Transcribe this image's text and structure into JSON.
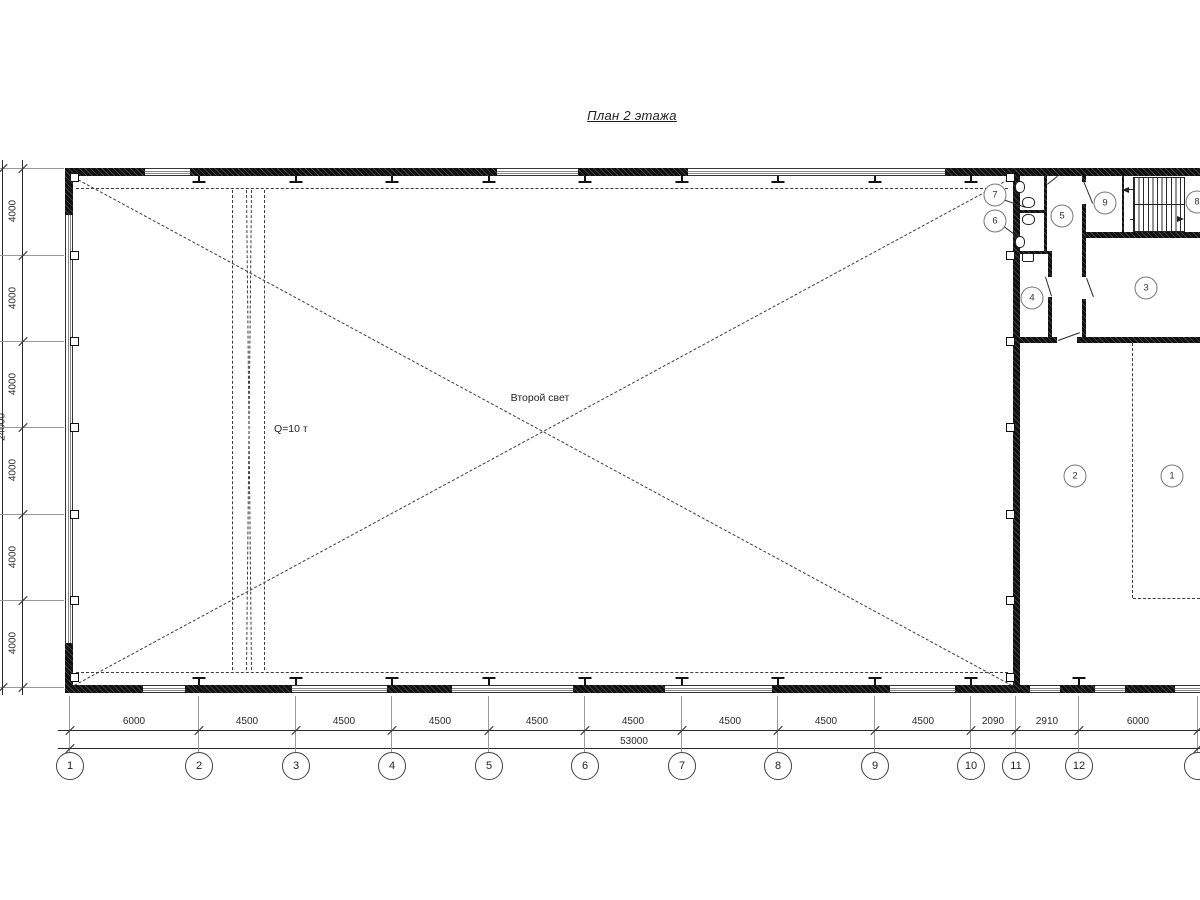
{
  "title": "План 2 этажа",
  "labels": {
    "second_light": "Второй свет",
    "crane_capacity": "Q=10 т",
    "total_bottom": "53000",
    "total_left": "24000"
  },
  "colors": {
    "ink": "#1a1a1a",
    "dash": "#3c3c3c",
    "extension": "#9a9a9a",
    "paper": "#ffffff"
  },
  "axes_bottom": [
    {
      "label": "1",
      "x": 70
    },
    {
      "label": "2",
      "x": 199
    },
    {
      "label": "3",
      "x": 296
    },
    {
      "label": "4",
      "x": 392
    },
    {
      "label": "5",
      "x": 489
    },
    {
      "label": "6",
      "x": 585
    },
    {
      "label": "7",
      "x": 682
    },
    {
      "label": "8",
      "x": 778
    },
    {
      "label": "9",
      "x": 875
    },
    {
      "label": "10",
      "x": 971
    },
    {
      "label": "11",
      "x": 1016
    },
    {
      "label": "12",
      "x": 1079
    },
    {
      "label": "",
      "x": 1198
    }
  ],
  "dims_bottom": [
    {
      "text": "6000",
      "x": 134
    },
    {
      "text": "4500",
      "x": 247
    },
    {
      "text": "4500",
      "x": 344
    },
    {
      "text": "4500",
      "x": 440
    },
    {
      "text": "4500",
      "x": 537
    },
    {
      "text": "4500",
      "x": 633
    },
    {
      "text": "4500",
      "x": 730
    },
    {
      "text": "4500",
      "x": 826
    },
    {
      "text": "4500",
      "x": 923
    },
    {
      "text": "2090",
      "x": 993
    },
    {
      "text": "2910",
      "x": 1047
    },
    {
      "text": "6000",
      "x": 1138
    }
  ],
  "dims_left": [
    {
      "text": "4000",
      "y": 211
    },
    {
      "text": "4000",
      "y": 298
    },
    {
      "text": "4000",
      "y": 384
    },
    {
      "text": "4000",
      "y": 470
    },
    {
      "text": "4000",
      "y": 557
    },
    {
      "text": "4000",
      "y": 643
    }
  ],
  "rooms": [
    {
      "n": "1",
      "x": 1172,
      "y": 476
    },
    {
      "n": "2",
      "x": 1075,
      "y": 476
    },
    {
      "n": "3",
      "x": 1146,
      "y": 288
    },
    {
      "n": "4",
      "x": 1032,
      "y": 298
    },
    {
      "n": "5",
      "x": 1062,
      "y": 216
    },
    {
      "n": "6",
      "x": 995,
      "y": 221
    },
    {
      "n": "7",
      "x": 995,
      "y": 195
    },
    {
      "n": "8",
      "x": 1197,
      "y": 202
    },
    {
      "n": "9",
      "x": 1105,
      "y": 203
    }
  ],
  "drawing": {
    "walls": [
      {
        "name": "top-wall",
        "x": 65,
        "y": 168,
        "w": 1135,
        "h": 8
      },
      {
        "name": "bottom-wall",
        "x": 65,
        "y": 685,
        "w": 1135,
        "h": 8
      },
      {
        "name": "left-wall-top",
        "x": 65,
        "y": 168,
        "w": 8,
        "h": 47
      },
      {
        "name": "left-wall-bottom",
        "x": 65,
        "y": 643,
        "w": 8,
        "h": 50
      },
      {
        "name": "divider-wall",
        "x": 1013,
        "y": 168,
        "w": 7,
        "h": 525
      },
      {
        "name": "toilet-partition",
        "x": 1044,
        "y": 176,
        "w": 3,
        "h": 78
      },
      {
        "name": "stall-partition",
        "x": 1020,
        "y": 210,
        "w": 24,
        "h": 3
      },
      {
        "name": "room4-top-wall",
        "x": 1020,
        "y": 251,
        "w": 32,
        "h": 3
      },
      {
        "name": "room4-right-wall",
        "x": 1048,
        "y": 251,
        "w": 4,
        "h": 26
      },
      {
        "name": "room4-right-wall",
        "x": 1048,
        "y": 297,
        "w": 4,
        "h": 45
      },
      {
        "name": "corridor-wall",
        "x": 1082,
        "y": 176,
        "w": 4,
        "h": 6
      },
      {
        "name": "corridor-wall",
        "x": 1082,
        "y": 204,
        "w": 4,
        "h": 73
      },
      {
        "name": "corridor-wall",
        "x": 1082,
        "y": 299,
        "w": 4,
        "h": 43
      },
      {
        "name": "understair-wall",
        "x": 1086,
        "y": 232,
        "w": 114,
        "h": 6
      },
      {
        "name": "stair-left-wall",
        "x": 1122,
        "y": 176,
        "w": 2,
        "h": 56
      },
      {
        "name": "room3-bottom-wall",
        "x": 1020,
        "y": 337,
        "w": 37,
        "h": 6
      },
      {
        "name": "room3-bottom-wall",
        "x": 1077,
        "y": 337,
        "w": 123,
        "h": 6
      }
    ],
    "windows_h": [
      {
        "x": 145,
        "y": 168,
        "w": 45
      },
      {
        "x": 497,
        "y": 168,
        "w": 81
      },
      {
        "x": 688,
        "y": 168,
        "w": 257
      },
      {
        "x": 143,
        "y": 685,
        "w": 42
      },
      {
        "x": 292,
        "y": 685,
        "w": 95
      },
      {
        "x": 452,
        "y": 685,
        "w": 121
      },
      {
        "x": 665,
        "y": 685,
        "w": 107
      },
      {
        "x": 890,
        "y": 685,
        "w": 65
      },
      {
        "x": 1030,
        "y": 685,
        "w": 30
      },
      {
        "x": 1095,
        "y": 685,
        "w": 30
      },
      {
        "x": 1175,
        "y": 685,
        "w": 25
      }
    ],
    "windows_v": [
      {
        "x": 65,
        "y": 215,
        "h": 428
      }
    ],
    "lines": [
      {
        "name": "diagonal-cross",
        "x1": 74,
        "y1": 177,
        "x2": 1012,
        "y2": 685,
        "dash": true
      },
      {
        "name": "diagonal-cross",
        "x1": 74,
        "y1": 685,
        "x2": 1012,
        "y2": 177,
        "dash": true
      },
      {
        "name": "opening-outline-top",
        "x1": 76,
        "y1": 188,
        "x2": 1008,
        "y2": 188,
        "dash": true
      },
      {
        "name": "opening-outline-bottom",
        "x1": 76,
        "y1": 672,
        "x2": 1008,
        "y2": 672,
        "dash": true
      },
      {
        "name": "crane-rail",
        "x1": 233,
        "y1": 190,
        "x2": 233,
        "y2": 670,
        "dash": true
      },
      {
        "name": "crane-rail",
        "x1": 265,
        "y1": 190,
        "x2": 265,
        "y2": 670,
        "dash": true
      },
      {
        "name": "crane-brace",
        "x1": 247,
        "y1": 190,
        "x2": 252,
        "y2": 670,
        "dash": true
      },
      {
        "name": "crane-brace",
        "x1": 252,
        "y1": 190,
        "x2": 247,
        "y2": 670,
        "dash": true
      },
      {
        "name": "room-divider-dashed",
        "x1": 1133,
        "y1": 343,
        "x2": 1133,
        "y2": 598,
        "dash": true
      },
      {
        "name": "room-divider-dashed",
        "x1": 1133,
        "y1": 598,
        "x2": 1200,
        "y2": 598,
        "dash": true
      },
      {
        "name": "leader-room7",
        "x1": 1003,
        "y1": 199,
        "x2": 1026,
        "y2": 207
      },
      {
        "name": "leader-room6",
        "x1": 1004,
        "y1": 226,
        "x2": 1024,
        "y2": 241
      },
      {
        "name": "door-leaf",
        "x1": 1084,
        "y1": 181,
        "x2": 1093,
        "y2": 203
      },
      {
        "name": "door-leaf",
        "x1": 1087,
        "y1": 278,
        "x2": 1094,
        "y2": 297
      },
      {
        "name": "door-leaf",
        "x1": 1046,
        "y1": 277,
        "x2": 1052,
        "y2": 296
      },
      {
        "name": "door-leaf",
        "x1": 1058,
        "y1": 340,
        "x2": 1080,
        "y2": 332
      },
      {
        "name": "door-leaf",
        "x1": 1047,
        "y1": 184,
        "x2": 1057,
        "y2": 176
      },
      {
        "name": "stair-arrow-line",
        "x1": 1180,
        "y1": 190,
        "x2": 1128,
        "y2": 190
      },
      {
        "name": "stair-arrow-line",
        "x1": 1130,
        "y1": 219,
        "x2": 1178,
        "y2": 219
      },
      {
        "name": "dim-rail",
        "x1": 58,
        "y1": 730,
        "x2": 1200,
        "y2": 730
      },
      {
        "name": "dim-rail",
        "x1": 58,
        "y1": 748,
        "x2": 1200,
        "y2": 748
      },
      {
        "name": "dim-rail-left",
        "x1": 23,
        "y1": 160,
        "x2": 23,
        "y2": 695
      },
      {
        "name": "dim-rail-left-outer",
        "x1": 3,
        "y1": 160,
        "x2": 3,
        "y2": 695
      }
    ],
    "ext_v_x": [
      70,
      199,
      296,
      392,
      489,
      585,
      682,
      778,
      875,
      971,
      1016,
      1079,
      1198
    ],
    "ext_h_y": [
      168,
      255,
      341,
      427,
      514,
      600,
      687
    ],
    "ticks_row1_y": 730,
    "ticks_row2": [
      {
        "x": 70,
        "y": 748
      },
      {
        "x": 1198,
        "y": 748
      }
    ],
    "ticks_left_x": 23,
    "ticks_left_outer": [
      {
        "x": 3,
        "y": 168
      },
      {
        "x": 3,
        "y": 687
      }
    ],
    "cols_top_x": [
      199,
      296,
      392,
      489,
      585,
      682,
      778,
      875,
      971
    ],
    "cols_bottom_x": [
      199,
      296,
      392,
      489,
      585,
      682,
      778,
      875,
      971,
      1079
    ],
    "squares_y": [
      177,
      255,
      341,
      427,
      514,
      600,
      677
    ],
    "fixtures": [
      {
        "name": "wc-fixture",
        "x": 1015,
        "y": 181,
        "w": 8,
        "h": 10,
        "r": true
      },
      {
        "name": "wc-fixture",
        "x": 1022,
        "y": 197,
        "w": 11,
        "h": 9,
        "r": true
      },
      {
        "name": "wc-fixture",
        "x": 1022,
        "y": 214,
        "w": 11,
        "h": 9,
        "r": true
      },
      {
        "name": "wc-fixture",
        "x": 1015,
        "y": 236,
        "w": 8,
        "h": 10,
        "r": true
      },
      {
        "name": "sink-fixture",
        "x": 1022,
        "y": 253,
        "w": 10,
        "h": 7,
        "r": false
      }
    ],
    "stairs": {
      "upper": {
        "x": 1133,
        "y": 177,
        "w": 50,
        "h": 26
      },
      "lower": {
        "x": 1133,
        "y": 204,
        "w": 50,
        "h": 26
      }
    }
  }
}
